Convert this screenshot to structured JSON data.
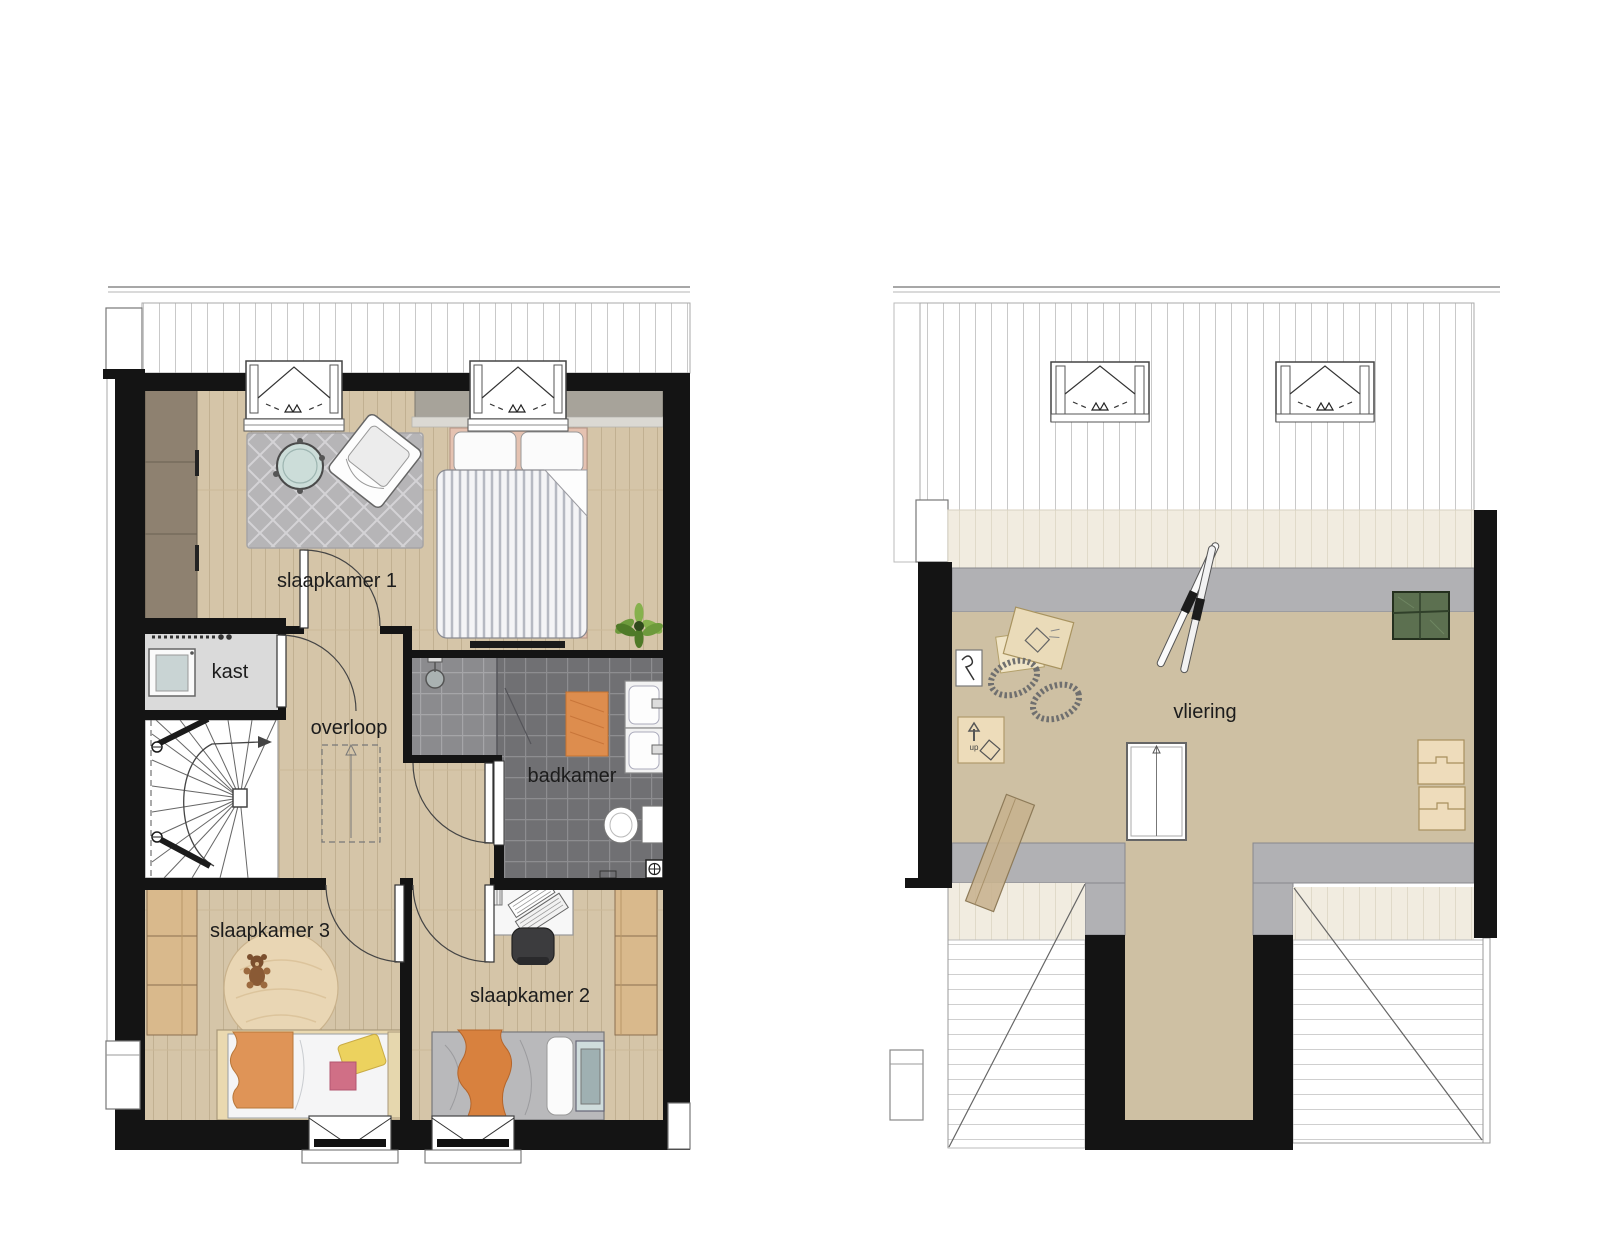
{
  "document": {
    "type": "architectural-floor-plan",
    "background": "#ffffff"
  },
  "plans": {
    "first_floor": {
      "rooms": {
        "slaapkamer1": "slaapkamer 1",
        "kast": "kast",
        "overloop": "overloop",
        "badkamer": "badkamer",
        "slaapkamer3": "slaapkamer 3",
        "slaapkamer2": "slaapkamer 2"
      }
    },
    "attic": {
      "rooms": {
        "vliering": "vliering"
      },
      "stair_marker": "up"
    }
  },
  "colors": {
    "wall": "#141414",
    "wood_floor": "#d5c5a8",
    "attic_floor": "#cec0a3",
    "bathroom_tile": "#707073",
    "shower_tile": "#8b8b8e",
    "knee_wall_gray": "#b1b1b4",
    "eave_cream": "#f1ece0",
    "rug_gray": "#b6b5b7",
    "round_rug_tan": "#e9d6b4",
    "accent_orange": "#dd8d4e",
    "closet_wood": "#d9b98c",
    "wardrobe_taupe": "#8e8170",
    "bed_pink": "#e5c2b1",
    "green_box": "#5c7050",
    "label_text": "#1c1c1c"
  }
}
